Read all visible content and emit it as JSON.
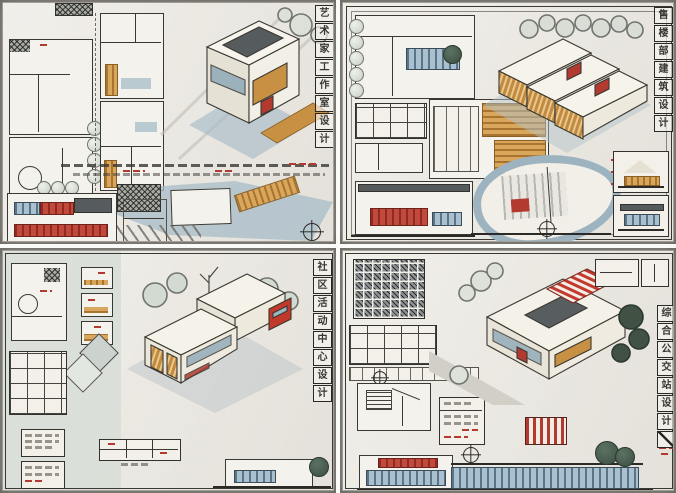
{
  "photo": {
    "background_color": "#8e8c85",
    "paper_color": "#edeae3",
    "gutter_color": "#fafaf8"
  },
  "colors": {
    "ink": "#3a3832",
    "wood_marker": "#c79043",
    "glass_blue": "#8fa9b7",
    "accent_red": "#b23a2f",
    "wash_blue": "#a7bcc8",
    "wash_green": "#d6dcd6",
    "tree_light": "#dde0d8",
    "tree_dark": "#415244",
    "roof_dark": "#565b5e"
  },
  "panels": [
    {
      "id": "artist-studio",
      "position": "top-left",
      "title": "艺术家工作室设计"
    },
    {
      "id": "sales-center",
      "position": "top-right",
      "title": "售楼部建筑设计"
    },
    {
      "id": "community-activity-center",
      "position": "bottom-left",
      "title": "社区活动中心设计"
    },
    {
      "id": "bus-station",
      "position": "bottom-right",
      "title": "综合公交站设计"
    }
  ]
}
